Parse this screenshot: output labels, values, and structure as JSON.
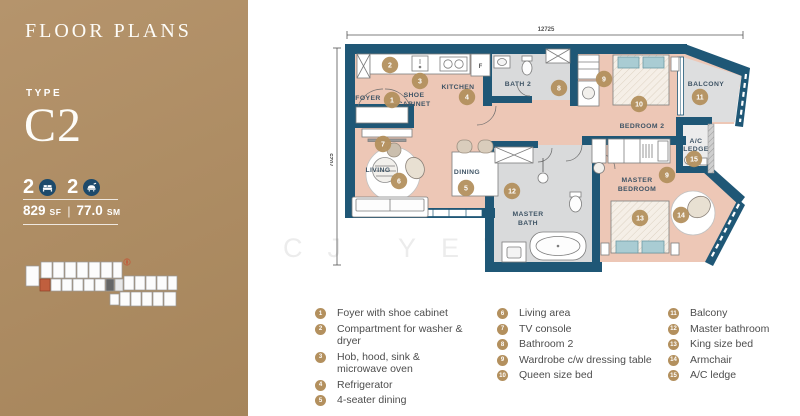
{
  "colors": {
    "panel_tan_light": "#b5946c",
    "panel_tan_dark": "#a6855b",
    "wall_teal": "#1f5776",
    "floor_pink": "#edc7b6",
    "floor_gray": "#d9dadb",
    "marker_tan": "#b3905e",
    "label_navy": "#3f5465",
    "legend_text": "#4d4d4d"
  },
  "panel": {
    "title": "FLOOR PLANS",
    "type_label": "TYPE",
    "type_value": "C2",
    "stats": {
      "bedrooms": "2",
      "bathrooms": "2"
    },
    "area": {
      "sf_value": "829",
      "sf_unit": "SF",
      "separator": "|",
      "sm_value": "77.0",
      "sm_unit": "SM"
    }
  },
  "plan": {
    "dim_width": "12725",
    "dim_height": "7025",
    "watermark": "CJ YEW",
    "rooms": {
      "foyer": "FOYER",
      "shoe_cabinet_1": "SHOE",
      "shoe_cabinet_2": "CABINET",
      "kitchen": "KITCHEN",
      "bath2": "BATH 2",
      "living": "LIVING",
      "dining": "DINING",
      "master_bath_1": "MASTER",
      "master_bath_2": "BATH",
      "master_bedroom_1": "MASTER",
      "master_bedroom_2": "BEDROOM",
      "bedroom2": "BEDROOM 2",
      "balcony": "BALCONY",
      "ac_ledge_1": "A/C",
      "ac_ledge_2": "LEDGE",
      "fridge": "F"
    }
  },
  "legend": {
    "items": [
      {
        "num": "1",
        "label": "Foyer with shoe cabinet"
      },
      {
        "num": "2",
        "label": "Compartment for washer & dryer"
      },
      {
        "num": "3",
        "label": "Hob, hood, sink & microwave oven"
      },
      {
        "num": "4",
        "label": "Refrigerator"
      },
      {
        "num": "5",
        "label": "4-seater dining"
      },
      {
        "num": "6",
        "label": "Living area"
      },
      {
        "num": "7",
        "label": "TV console"
      },
      {
        "num": "8",
        "label": "Bathroom 2"
      },
      {
        "num": "9",
        "label": "Wardrobe c/w dressing table"
      },
      {
        "num": "10",
        "label": "Queen size bed"
      },
      {
        "num": "11",
        "label": "Balcony"
      },
      {
        "num": "12",
        "label": "Master bathroom"
      },
      {
        "num": "13",
        "label": "King size bed"
      },
      {
        "num": "14",
        "label": "Armchair"
      },
      {
        "num": "15",
        "label": "A/C ledge"
      }
    ]
  }
}
